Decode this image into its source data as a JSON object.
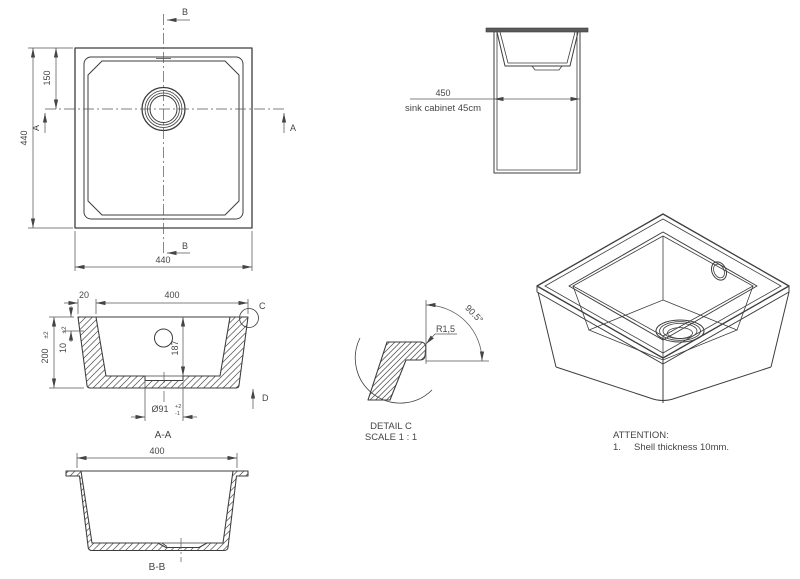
{
  "colors": {
    "line": "#3d3d3d",
    "dim": "#565656",
    "text": "#454545",
    "bg": "#ffffff"
  },
  "drawing": {
    "plan": {
      "dim_left": "440",
      "dim_offset": "150",
      "dim_bottom": "440",
      "section_a": "A",
      "section_b": "B"
    },
    "cabinet": {
      "dim": "450",
      "caption": "sink cabinet 45cm"
    },
    "aa": {
      "dim_rim": "20",
      "dim_width": "400",
      "dim_height": "200",
      "dim_height_tol": "±2",
      "dim_shell": "10",
      "dim_shell_tol": "±2",
      "dim_depth": "187",
      "dim_drain": "Ø91",
      "drain_tol_plus": "+2",
      "drain_tol_minus": "-1",
      "label": "A-A",
      "detail_ref": "C",
      "view_ref": "D"
    },
    "dc": {
      "title": "DETAIL C",
      "scale": "SCALE 1 : 1",
      "radius": "R1,5",
      "angle": "90.5°"
    },
    "bb": {
      "dim_width": "400",
      "label": "B-B"
    },
    "attention": {
      "title": "ATTENTION:",
      "item_no": "1.",
      "item_text": "Shell thickness 10mm."
    }
  }
}
